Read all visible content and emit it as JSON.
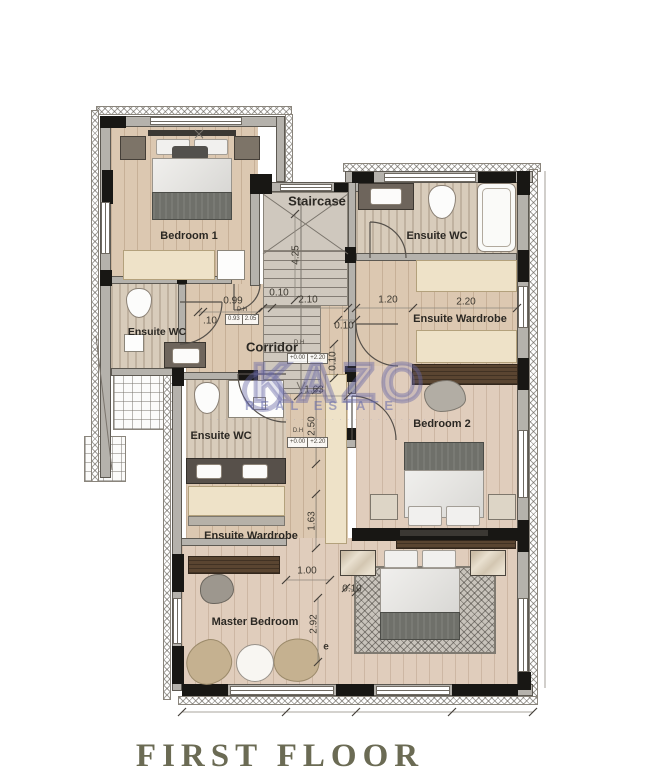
{
  "title": "FIRST FLOOR",
  "watermark": {
    "brand": "KAZO",
    "subtitle": "REAL ESTATE",
    "tagline": "· · · · · · · · · · · · · · · · · · · · · · · · · · · · · · · ·"
  },
  "rooms": {
    "bedroom1": {
      "label": "Bedroom 1"
    },
    "staircase": {
      "label": "Staircase"
    },
    "ensuite_wc_right": {
      "label": "Ensuite WC"
    },
    "ensuite_wardrobe_right": {
      "label": "Ensuite Wardrobe"
    },
    "bedroom2": {
      "label": "Bedroom 2"
    },
    "ensuite_wc_upper_left": {
      "label": "Ensuite WC"
    },
    "corridor": {
      "label": "Corridor"
    },
    "ensuite_wc_lower_left": {
      "label": "Ensuite WC"
    },
    "ensuite_wardrobe_left": {
      "label": "Ensuite Wardrobe"
    },
    "master_bedroom": {
      "label": "Master Bedroom"
    }
  },
  "dimensions": {
    "stair_height": "4.25",
    "stair_offset": "0.10",
    "stair_width": "2.10",
    "corridor_niche": "0.99",
    "corridor_niche_small": ".10",
    "wc_right_door": "1.20",
    "wardrobe_right_width": "2.20",
    "corridor_gap_h": "0.10",
    "corridor_gap_v": "0.10",
    "hall_width": "1.63",
    "hall_upper": "2.50",
    "hall_lower": "1.63",
    "master_door": "1.00",
    "master_gap": "0.10",
    "master_depth": "2.92",
    "node_e": "e"
  },
  "annotations": {
    "door_tag": "D.H",
    "door_w": "0.93",
    "door_h": "2.05",
    "level_tag": "D.H",
    "level_low": "+0.00",
    "level_high": "+2.20",
    "level_low2": "+0.00",
    "level_high2": "+2.20"
  },
  "colors": {
    "wood": "#dcc8b1",
    "travertine": "#d8ccbb",
    "wall_gray": "#b5b2ac",
    "column_black": "#181714",
    "cream": "#eee2c8",
    "watermark": "#6464a5",
    "title_olive": "#6b6b54"
  }
}
